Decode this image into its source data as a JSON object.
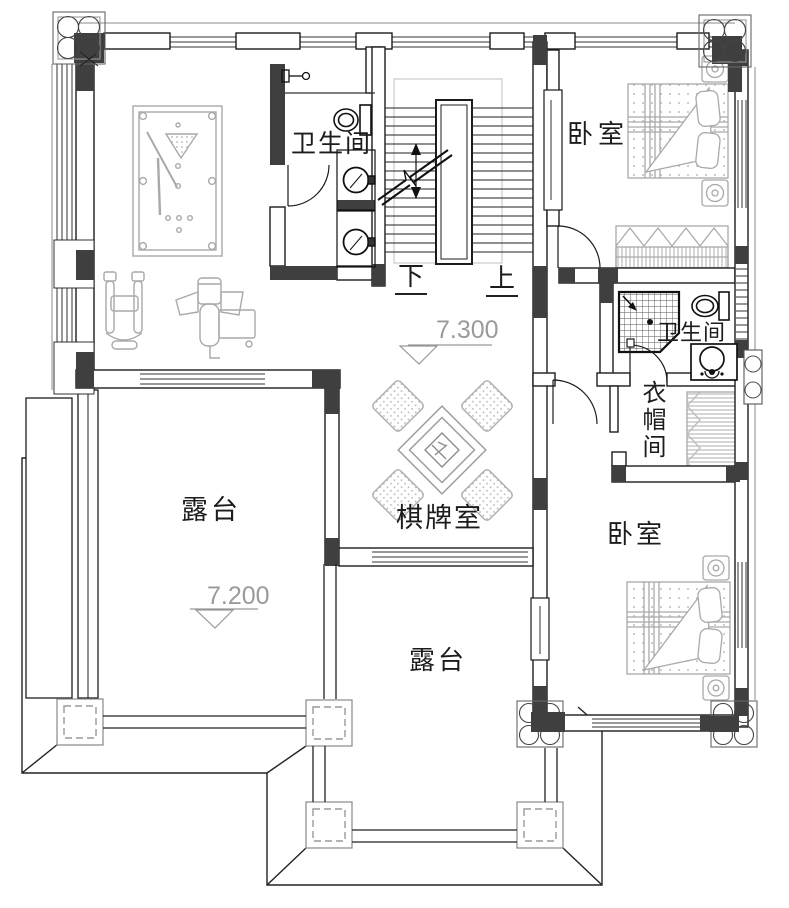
{
  "labels": {
    "bathroom_top": "卫生间",
    "bedroom_top": "卧室",
    "bathroom_right": "卫生间",
    "cloakroom": "衣帽间",
    "chess_room": "棋牌室",
    "bedroom_bottom": "卧室",
    "terrace_left": "露台",
    "terrace_bottom": "露台",
    "stair_down": "下",
    "stair_up": "上"
  },
  "elevations": {
    "hall_level": "7.300",
    "terrace_level": "7.200"
  },
  "icons": {
    "pool_table": "pool-table-icon",
    "gym_equipment": "gym-equipment-icon",
    "mahjong_table": "mahjong-table-icon",
    "bed": "bed-icon",
    "nightstand": "nightstand-icon",
    "wardrobe": "wardrobe-icon",
    "toilet": "toilet-icon",
    "sink": "sink-icon",
    "shower": "shower-icon",
    "stairs": "stairs-icon",
    "column_quatrefoil": "corner-column-icon",
    "column_dashed": "pergola-column-icon",
    "elevation_marker": "elevation-marker-icon"
  },
  "colors": {
    "wall_line": "#1c1c1c",
    "wall_poche": "#3f3f3f",
    "furniture": "#a9a9a9",
    "annotation_gray": "#999999",
    "background": "#ffffff"
  }
}
